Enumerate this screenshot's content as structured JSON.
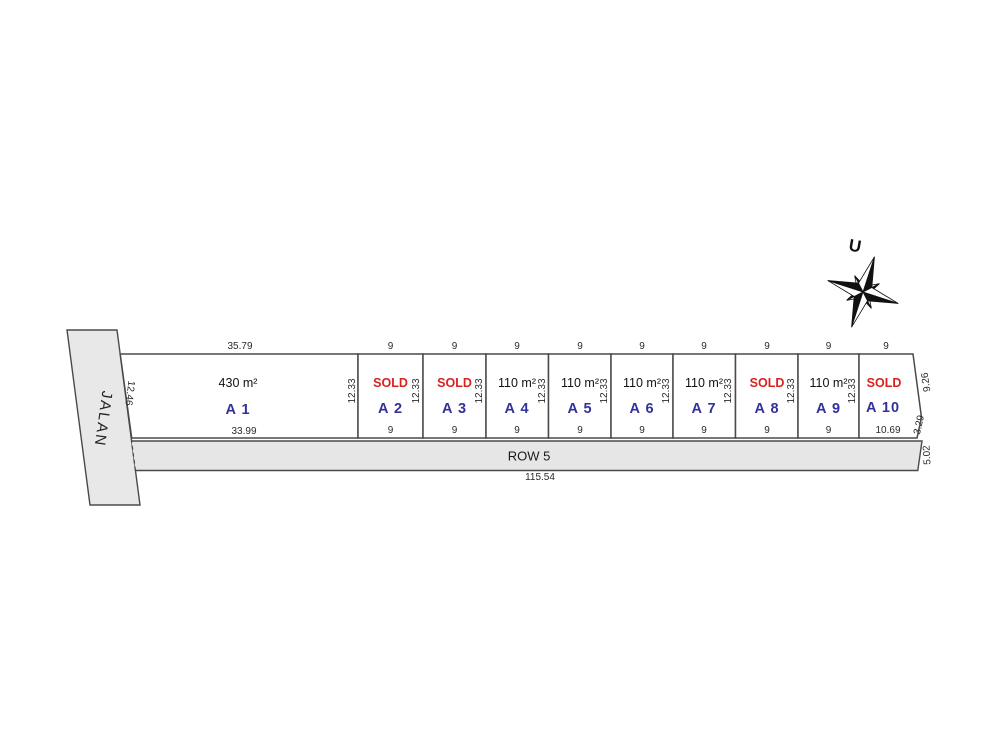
{
  "road": {
    "label": "JALAN"
  },
  "compass": {
    "north_label": "U"
  },
  "row_strip": {
    "label": "ROW 5",
    "total_width_dim": "115.54",
    "right_dim": "5.02"
  },
  "lots": [
    {
      "name": "A 1",
      "area": "430 m²",
      "top_dim": "35.79",
      "bottom_dim": "33.99",
      "left_dim": "12.46",
      "right_dim": "12.33"
    },
    {
      "name": "A 2",
      "status": "SOLD",
      "top_dim": "9",
      "bottom_dim": "9",
      "right_dim": "12.33"
    },
    {
      "name": "A 3",
      "status": "SOLD",
      "top_dim": "9",
      "bottom_dim": "9",
      "right_dim": "12.33"
    },
    {
      "name": "A 4",
      "area": "110 m²",
      "top_dim": "9",
      "bottom_dim": "9",
      "right_dim": "12.33"
    },
    {
      "name": "A 5",
      "area": "110 m²",
      "top_dim": "9",
      "bottom_dim": "9",
      "right_dim": "12.33"
    },
    {
      "name": "A 6",
      "area": "110 m²",
      "top_dim": "9",
      "bottom_dim": "9",
      "right_dim": "12.33"
    },
    {
      "name": "A 7",
      "area": "110 m²",
      "top_dim": "9",
      "bottom_dim": "9",
      "right_dim": "12.33"
    },
    {
      "name": "A 8",
      "status": "SOLD",
      "top_dim": "9",
      "bottom_dim": "9",
      "right_dim": "12.33"
    },
    {
      "name": "A 9",
      "area": "110 m²",
      "top_dim": "9",
      "bottom_dim": "9",
      "right_dim": "12.33"
    },
    {
      "name": "A 10",
      "status": "SOLD",
      "top_dim": "9",
      "bottom_dim": "10.69",
      "right_edge_dim": "9.26",
      "corner_edge_dim": "3.29"
    }
  ],
  "colors": {
    "sold_text": "#d8231f",
    "lot_name_text": "#32329a",
    "dimension_text": "#2a2a2a",
    "line": "#4a4a4a",
    "parcel_fill": "#ffffff",
    "road_fill": "#e8e8e8"
  }
}
